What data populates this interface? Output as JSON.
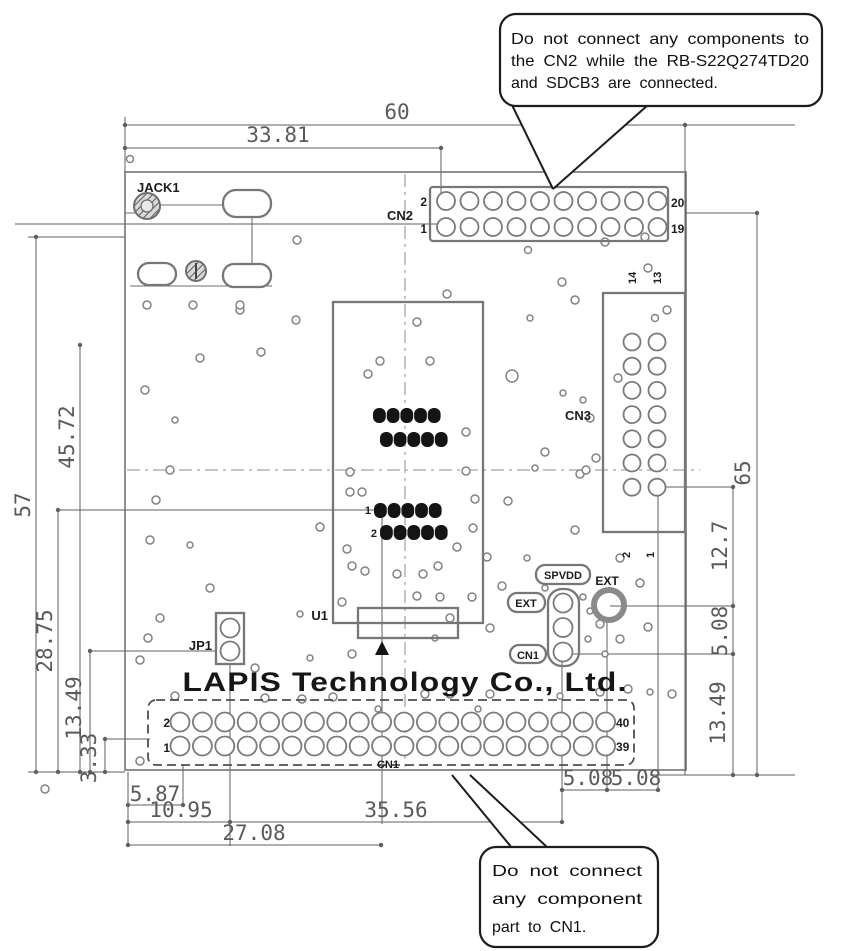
{
  "callouts": {
    "top": {
      "line1": "Do not connect any components to",
      "line2": "the CN2 while the RB-S22Q274TD20",
      "line3": "and SDCB3 are connected."
    },
    "bottom": {
      "line1": "Do not connect",
      "line2": "any component",
      "line3": "part to CN1."
    }
  },
  "silkscreen": {
    "brand": "LAPIS Technology Co., Ltd.",
    "jack1": "JACK1",
    "jp1": "JP1",
    "u1": "U1",
    "spvdd": "SPVDD",
    "ext_box": "EXT",
    "cn1_box": "CN1",
    "ext_pad": "EXT"
  },
  "connectors": {
    "cn2": {
      "label": "CN2",
      "rows": 2,
      "cols": 10,
      "pin_top_left": "2",
      "pin_bottom_left": "1",
      "pin_top_right": "20",
      "pin_bottom_right": "19"
    },
    "cn3": {
      "label": "CN3",
      "rows": 7,
      "cols": 2,
      "pin_top_left": "14",
      "pin_top_right": "13",
      "pin_bottom_left": "2",
      "pin_bottom_right": "1"
    },
    "cn1": {
      "label": "CN1",
      "rows": 2,
      "cols": 20,
      "pin_top_left": "2",
      "pin_bottom_left": "1",
      "pin_top_right": "40",
      "pin_bottom_right": "39"
    },
    "jp1": {
      "rows": 2,
      "cols": 1
    },
    "aux_header": {
      "rows": 3,
      "cols": 1
    },
    "u1_socket": {
      "dot_rows": 4,
      "dots_per_row": 5,
      "pin_row3": "1",
      "pin_row4": "2"
    }
  },
  "dimensions": {
    "top_width": "60",
    "top_cn2_offset": "33.81",
    "left_57": "57",
    "left_4572": "45.72",
    "left_2875": "28.75",
    "left_1349": "13.49",
    "left_333": "3.33",
    "bottom_587": "5.87",
    "bottom_1095": "10.95",
    "bottom_2708": "27.08",
    "bottom_3556": "35.56",
    "bottom_508a": "5.08",
    "bottom_508b": "5.08",
    "right_65": "65",
    "right_127": "12.7",
    "right_508": "5.08",
    "right_1349": "13.49"
  }
}
